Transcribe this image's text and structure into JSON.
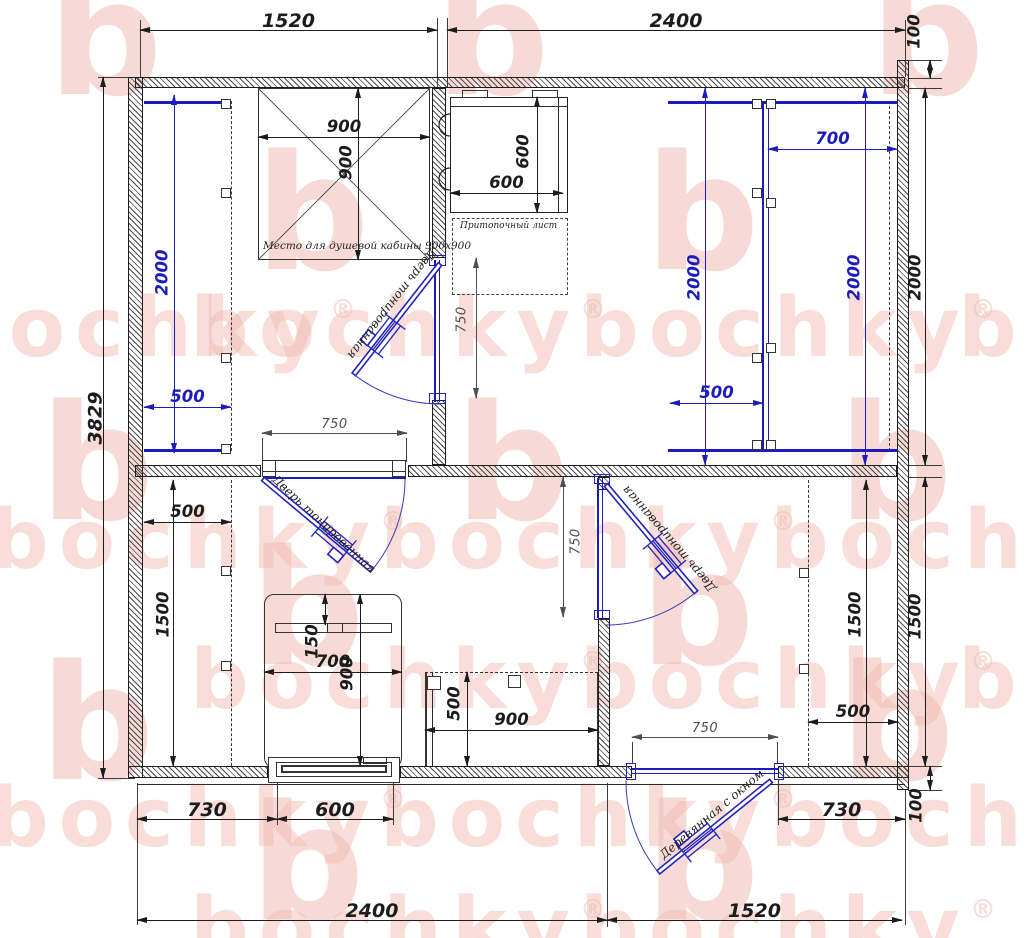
{
  "watermark": {
    "word": "bochky",
    "reg": "®",
    "letter": "b"
  },
  "labels": {
    "shower_area": "Место для душевой кабины 900x900",
    "hearth_plate": "Притопочный лист",
    "door_tinted": "Дверь тонированная",
    "door_entrance": "Деревянная с окном"
  },
  "dims": {
    "top_left_width": "1520",
    "top_right_width": "2400",
    "top_overhang": "100",
    "overall_height": "3829",
    "shower_width": "900",
    "shower_depth": "900",
    "stove_width": "600",
    "stove_height": "600",
    "steam_bench_right_depth": "700",
    "wash_bench_length": "2000",
    "steam_bench_left_length": "2000",
    "steam_bench_right_length": "2000",
    "steam_room_side": "2000",
    "wash_bench_depth": "500",
    "steam_bench_left_depth": "500",
    "shower_door": "750",
    "rest_door": "750",
    "hall_door": "750",
    "entry_door": "750",
    "rest_shelf_depth": "500",
    "rest_room_height": "1500",
    "hall_room_height": "1500",
    "right_lower_side": "1500",
    "bed_headboard": "150",
    "bed_width": "700",
    "bed_length": "900",
    "bench_depth": "500",
    "bench_width": "900",
    "hall_shelf_depth": "500",
    "bottom_left_run": "730",
    "window_width": "600",
    "bottom_right_run": "730",
    "bottom_overhang": "100",
    "bottom_left_width": "2400",
    "bottom_right_width": "1520"
  }
}
